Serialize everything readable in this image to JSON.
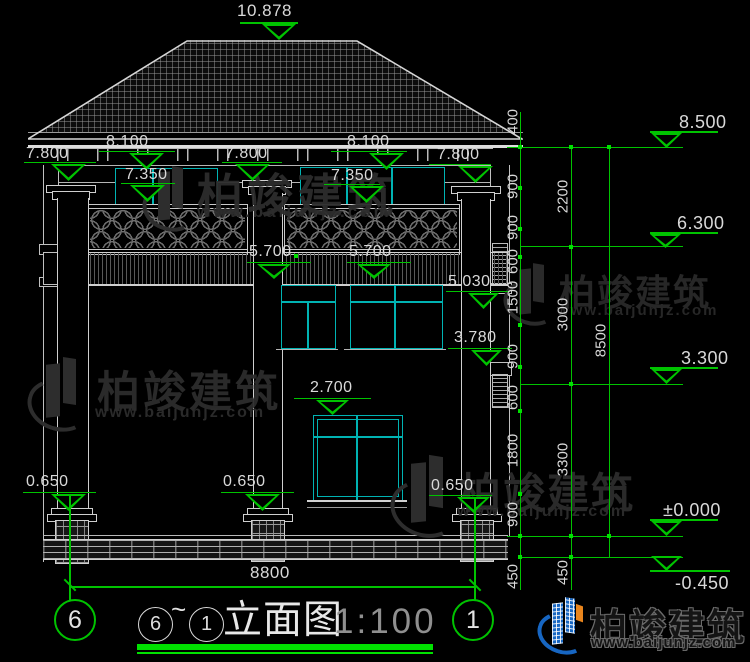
{
  "colors": {
    "green": "#00c300",
    "bright_green": "#00e100",
    "cyan": "#00b3b3",
    "line_white": "#d0d0d0",
    "text": "#d9d9d9",
    "muted": "#8f8f8f",
    "watermark_gray": "#2d2d2d",
    "logo_blue": "#1766c2",
    "logo_orange": "#e8851d"
  },
  "dims": {
    "ridge": "10.878",
    "eave_left_outer": "7.800",
    "eave_left_upper": "8.100",
    "eave_left_inner": "7.350",
    "eave_center": "7.800",
    "eave_right_upper": "8.100",
    "eave_right_inner": "7.350",
    "eave_right_outer": "7.800",
    "balcony_left": "5.700",
    "balcony_right": "5.700",
    "lvl_5030": "5.030",
    "lvl_3780": "3.780",
    "lvl_2700": "2.700",
    "plinth_left": "0.650",
    "plinth_center": "0.650",
    "plinth_right": "0.650",
    "overall_width": "8800"
  },
  "levels": {
    "eave": "8.500",
    "floor2_top": "6.300",
    "floor1_top": "3.300",
    "ground": "±0.000",
    "site": "-0.450"
  },
  "chains": {
    "inner": [
      "400",
      "900",
      "900",
      "600",
      "1500",
      "900",
      "600",
      "1800",
      "900",
      "450"
    ],
    "middle": [
      "2200",
      "3000",
      "3300",
      "450"
    ],
    "outer": [
      "8500"
    ]
  },
  "grid": {
    "left": "6",
    "right": "1"
  },
  "title": {
    "from": "6",
    "tilde": "~",
    "to": "1",
    "name": "立面图",
    "scale": "1:100"
  },
  "watermark": {
    "brand": "柏竣建筑",
    "site": "www.baijunjz.com"
  }
}
